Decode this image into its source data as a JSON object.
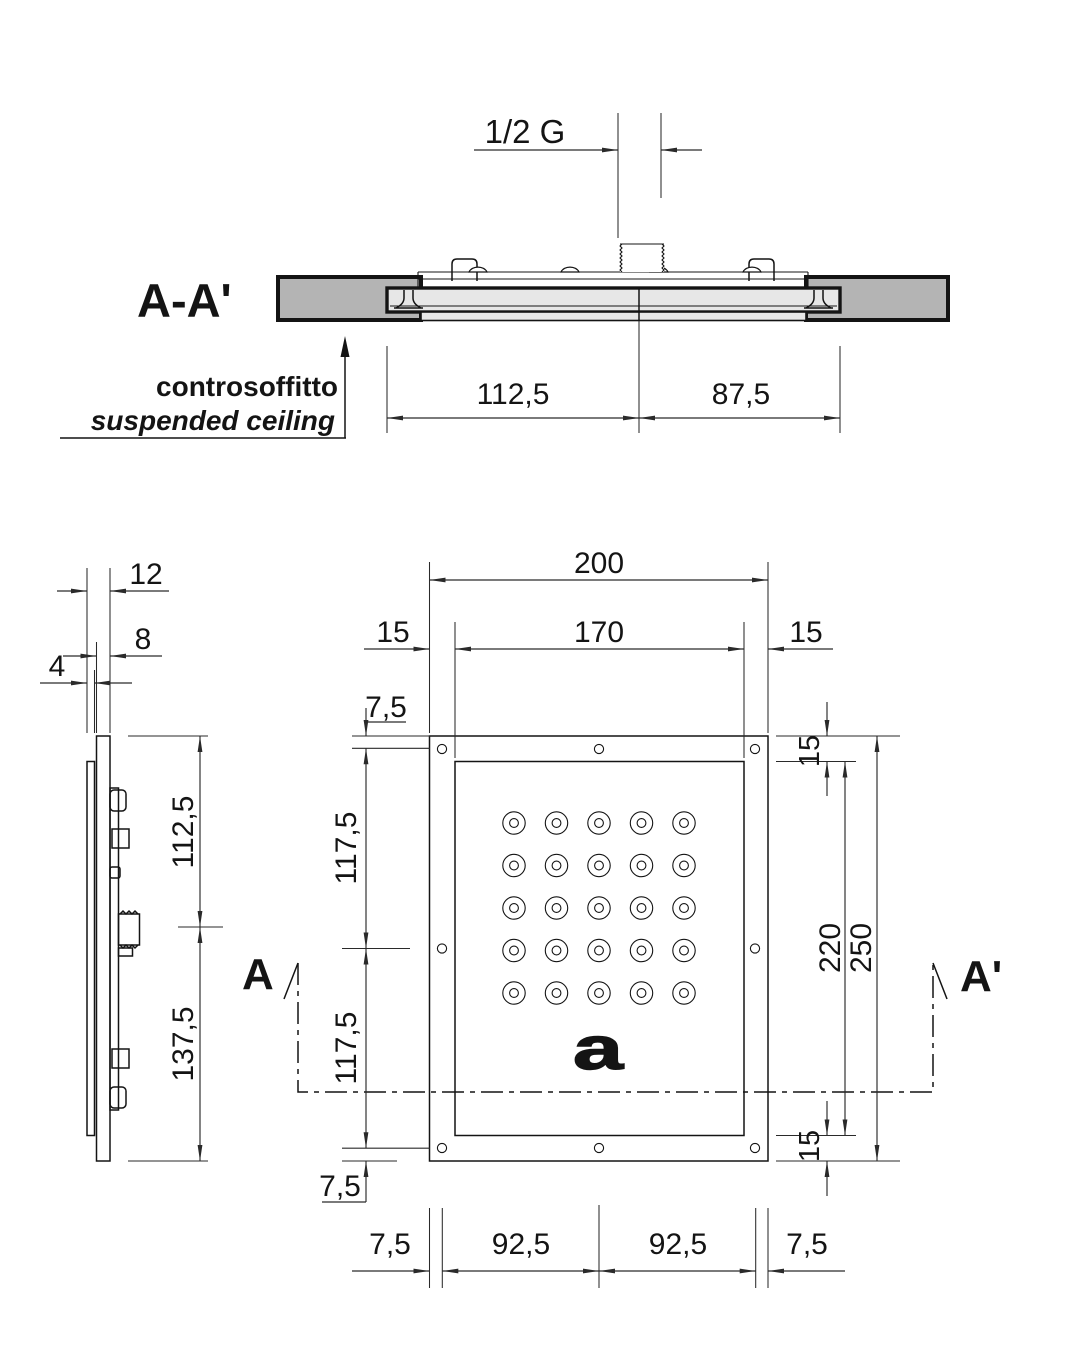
{
  "section_view": {
    "title": "A-A'",
    "thread_label": "1/2 G",
    "ceiling_label_primary": "controsoffitto",
    "ceiling_label_secondary": "suspended ceiling",
    "dim_left_of_axis": "112,5",
    "dim_right_of_axis": "87,5"
  },
  "side_view": {
    "dim_depth_overall": "12",
    "dim_depth_body": "8",
    "dim_depth_panel": "4",
    "dim_height_upper": "112,5",
    "dim_height_lower": "137,5"
  },
  "front_view": {
    "logo_letter": "a",
    "marker_start": "A",
    "marker_end": "A'",
    "dims_top": {
      "overall_width": "200",
      "margin_left": "15",
      "inner_width": "170",
      "margin_right": "15"
    },
    "dims_left": {
      "screw_edge_top": "7,5",
      "upper_half": "117,5",
      "lower_half": "117,5",
      "screw_edge_bottom": "7,5"
    },
    "dims_right": {
      "margin_top": "15",
      "inner_height": "220",
      "overall_height": "250",
      "margin_bottom": "15"
    },
    "dims_bottom": {
      "screw_edge_left": "7,5",
      "screw_span_left": "92,5",
      "screw_span_right": "92,5",
      "screw_edge_right": "7,5"
    }
  }
}
